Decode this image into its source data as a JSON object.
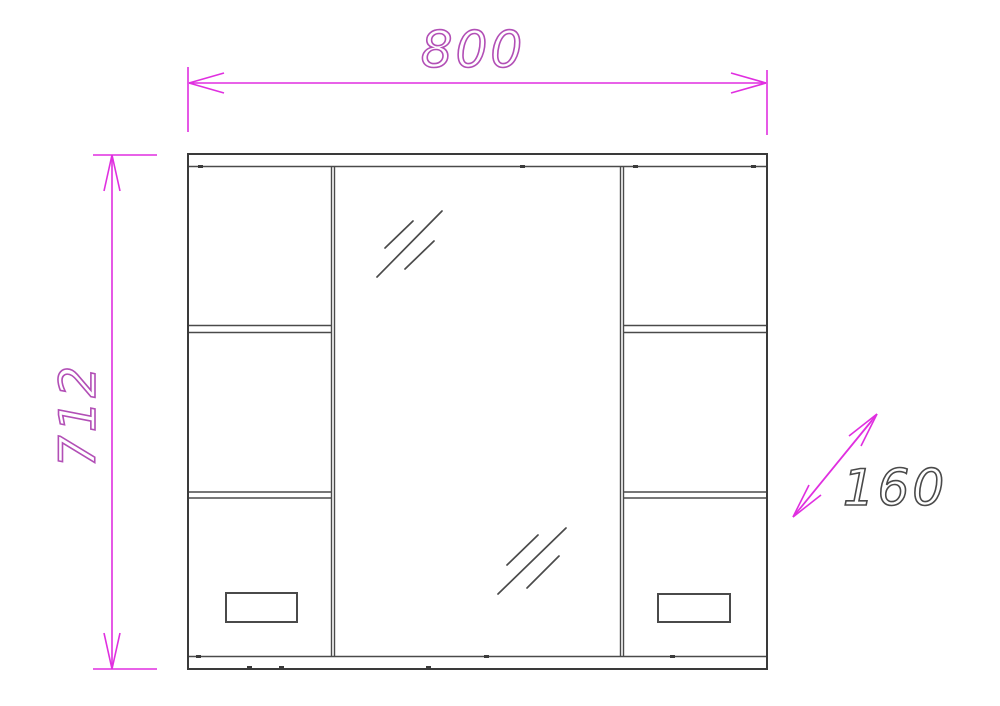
{
  "drawing": {
    "subject": "mirror-cabinet-front-elevation",
    "dimensions": {
      "width": {
        "value": "800",
        "orientation": "horizontal",
        "position": "top"
      },
      "height": {
        "value": "712",
        "orientation": "vertical",
        "position": "left"
      },
      "depth": {
        "value": "160",
        "orientation": "diagonal",
        "position": "right"
      }
    },
    "colors": {
      "dimension_line": "#e02fe0",
      "size_text": "#b24fb6",
      "depth_text": "#4a4a4a",
      "outline": "#3a3a3a",
      "detail": "#4a4a4a",
      "background": "#ffffff"
    }
  }
}
